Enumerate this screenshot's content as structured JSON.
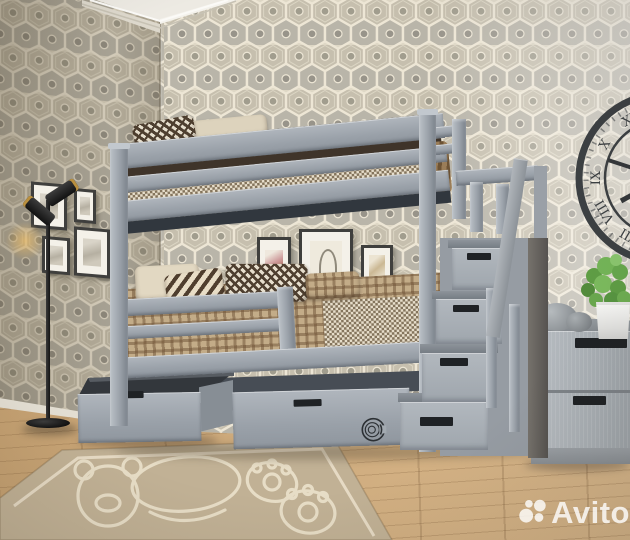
{
  "watermark": {
    "brand": "Avito"
  },
  "clock": {
    "numerals": {
      "xi": "XI",
      "x": "X",
      "ix": "IX",
      "viii": "VIII",
      "vii": "VII"
    }
  },
  "palette": {
    "bed_gray": "#9aa1a9",
    "bed_gray_light": "#b7bdc4",
    "bed_gray_dark": "#7e858d",
    "stair_newel": "#6b6762",
    "wall_cream": "#ddd6c4",
    "hex_taupe": "#c6bfae",
    "hex_gray": "#b9b5a9",
    "hex_outline": "#ede6d5",
    "floor_wood": "#cda97c",
    "rug_beige": "#c1b195",
    "rug_line": "#ece2cc",
    "bedding_brown": "#8a7257",
    "bedding_cream": "#e6dcc6",
    "pillow_dark": "#4e3f30",
    "plant_green": "#6aa84f",
    "pot_white": "#f6f6f4",
    "lamp_black": "#222222",
    "brass": "#b98f3e",
    "frame_black": "#3f3f3d",
    "clock_metal": "#3c4043",
    "stone_gray": "#979ca0",
    "watermark_white": "rgba(255,255,255,0.8)"
  }
}
